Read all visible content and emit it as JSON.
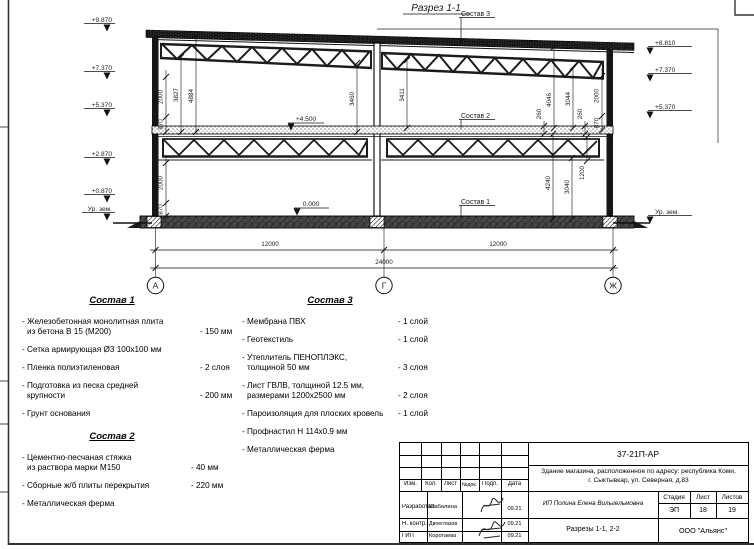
{
  "drawing": {
    "title": "Разрез 1-1",
    "callout_1": "Состав 1",
    "callout_2": "Состав 2",
    "callout_3": "Состав 3",
    "levels_left": {
      "l1": "+9.870",
      "l2": "+7.370",
      "l3": "+5.370",
      "l4": "+2.870",
      "l5": "+0.870",
      "l6": "Ур. зем."
    },
    "levels_right": {
      "r1": "+8.810",
      "r2": "+7.370",
      "r3": "+5.370",
      "r4": "Ур. зем."
    },
    "levels_inner": {
      "i1": "+4.500",
      "i2": "0.000"
    },
    "vdims": {
      "a2000": "2000",
      "a870": "870",
      "a3827": "3827",
      "a4884": "4884",
      "a3460": "3460",
      "b3411": "3411",
      "b4046": "4046",
      "b3044": "3044",
      "b260a": "260",
      "b260b": "260",
      "c2000": "2000",
      "c870": "870",
      "d4240": "4240",
      "d3040": "3040",
      "d1200": "1200",
      "e2000": "2000",
      "e870": "870"
    },
    "hdims": {
      "span1": "12000",
      "span2": "12000",
      "total": "24000"
    },
    "axes": {
      "a1": "А",
      "a2": "Г",
      "a3": "Ж"
    }
  },
  "comp1": {
    "title": "Состав 1",
    "items": [
      {
        "lines": [
          "- Железобетонная  монолитная плита",
          "из бетона В 15 (М200)"
        ],
        "value": "- 150 мм"
      },
      {
        "lines": [
          "- Сетка армирующая Ø3 100х100 мм"
        ],
        "value": ""
      },
      {
        "lines": [
          "- Пленка полиэтиленовая"
        ],
        "value": "-  2 слоя"
      },
      {
        "lines": [
          "- Подготовка из песка средней",
          "крупности"
        ],
        "value": "- 200 мм"
      },
      {
        "lines": [
          "- Грунт основания"
        ],
        "value": ""
      }
    ]
  },
  "comp2": {
    "title": "Состав 2",
    "items": [
      {
        "lines": [
          "- Цементно-песчаная стяжка",
          "из раствора марки М150"
        ],
        "value": "- 40 мм"
      },
      {
        "lines": [
          "- Сборные ж/б плиты перекрытия"
        ],
        "value": "- 220 мм"
      },
      {
        "lines": [
          "- Металлическая ферма"
        ],
        "value": ""
      }
    ]
  },
  "comp3": {
    "title": "Состав 3",
    "items": [
      {
        "lines": [
          "- Мембрана ПВХ"
        ],
        "value": "- 1 слой"
      },
      {
        "lines": [
          "- Геотекстиль"
        ],
        "value": "- 1 слой"
      },
      {
        "lines": [
          "- Утеплитель ПЕНОПЛЭКС,",
          "толщиной 50 мм"
        ],
        "value": "- 3 слоя"
      },
      {
        "lines": [
          "- Лист ГВЛВ, толщиной 12.5 мм,",
          "размерами 1200х2500 мм"
        ],
        "value": "- 2 слоя"
      },
      {
        "lines": [
          "- Пароизоляция для плоских кровель"
        ],
        "value": "- 1 слой"
      },
      {
        "lines": [
          "- Профнастил Н 114х0.9 мм"
        ],
        "value": ""
      },
      {
        "lines": [
          "- Металлическая ферма"
        ],
        "value": ""
      }
    ]
  },
  "titleblock": {
    "doc_code": "37-21П-АР",
    "object_line1": "Здание магазина, расположенное по адресу: республика Коми,",
    "object_line2": "г. Сыктывкар, ул. Северная, д.83",
    "designer": "ИП Полина Елена Вильгельмовна",
    "sheet_title": "Разрезы 1-1, 2-2",
    "company": "ООО \"Альянс\"",
    "head": {
      "izm": "Изм.",
      "kol": "Кол.",
      "list": "Лист",
      "ndoc": "№док.",
      "podp": "Подп.",
      "data": "Дата"
    },
    "stage": {
      "h1": "Стадия",
      "h2": "Лист",
      "h3": "Листов",
      "v1": "ЭП",
      "v2": "18",
      "v3": "19"
    },
    "rows": [
      {
        "role": "Разработал",
        "name": "Шабалина",
        "date": "09.21"
      },
      {
        "role": "Н. контр.",
        "name": "Двоеглазов",
        "date": "09.21"
      },
      {
        "role": "ГИП",
        "name": "Коротаева",
        "date": "09.21"
      }
    ]
  }
}
